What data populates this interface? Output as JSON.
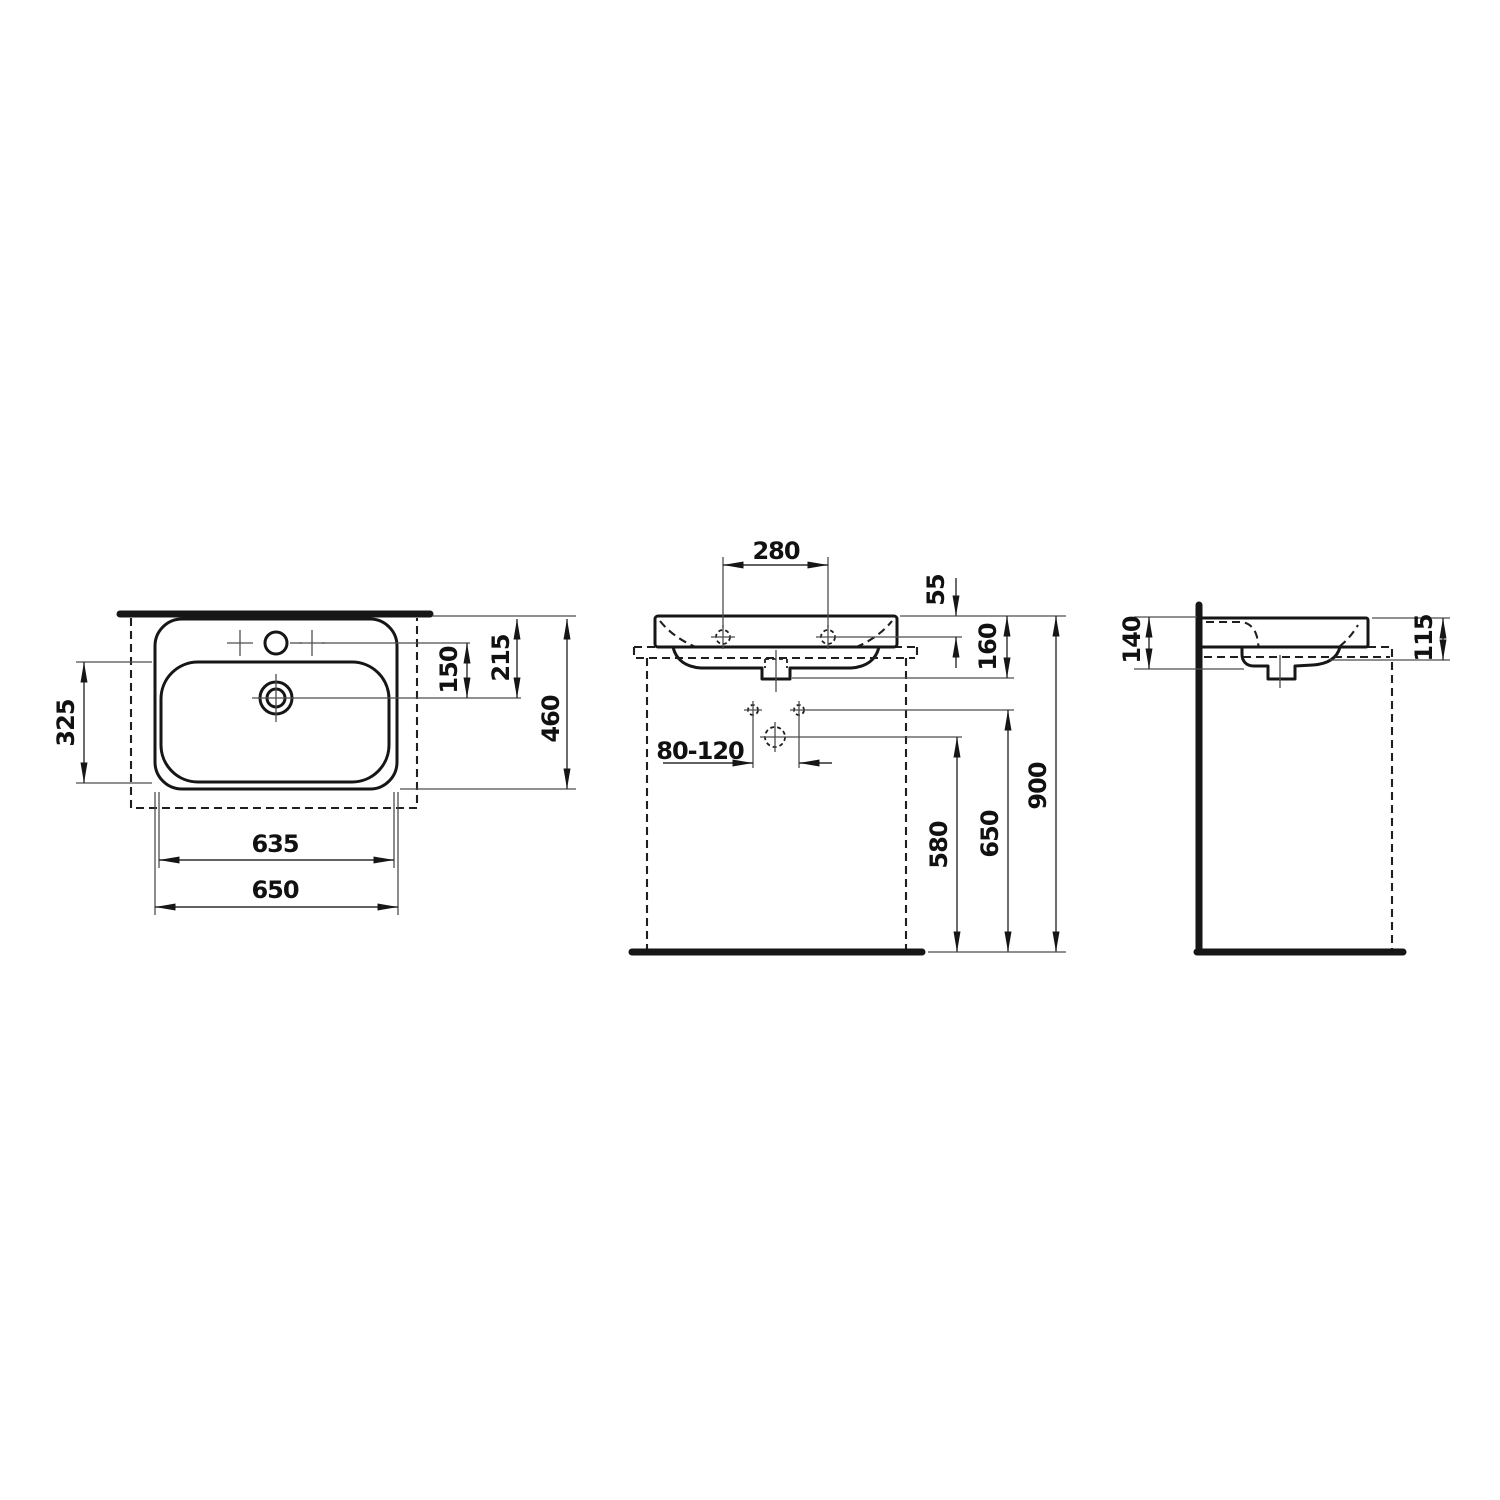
{
  "drawing": {
    "kind": "washbasin technical dimension drawing, three orthographic views",
    "colors": {
      "line": "#161616",
      "thin_line": "#4d4d4d",
      "background": "#ffffff"
    },
    "views": {
      "top": {
        "dims": {
          "bowl_depth": "325",
          "tap_to_drain": "150",
          "rim_to_drain": "215",
          "overall_depth": "460",
          "width_inner": "635",
          "width_overall": "650"
        }
      },
      "front": {
        "dims": {
          "tap_hole_spacing": "280",
          "rim_to_tap_holes": "55",
          "body_height": "160",
          "trap_offset_range": "80-120",
          "drain_height": "580",
          "supply_height": "650",
          "rim_height": "900"
        }
      },
      "side": {
        "dims": {
          "depth_at_wall": "140",
          "rim_to_hidden_edge": "115"
        }
      }
    }
  }
}
